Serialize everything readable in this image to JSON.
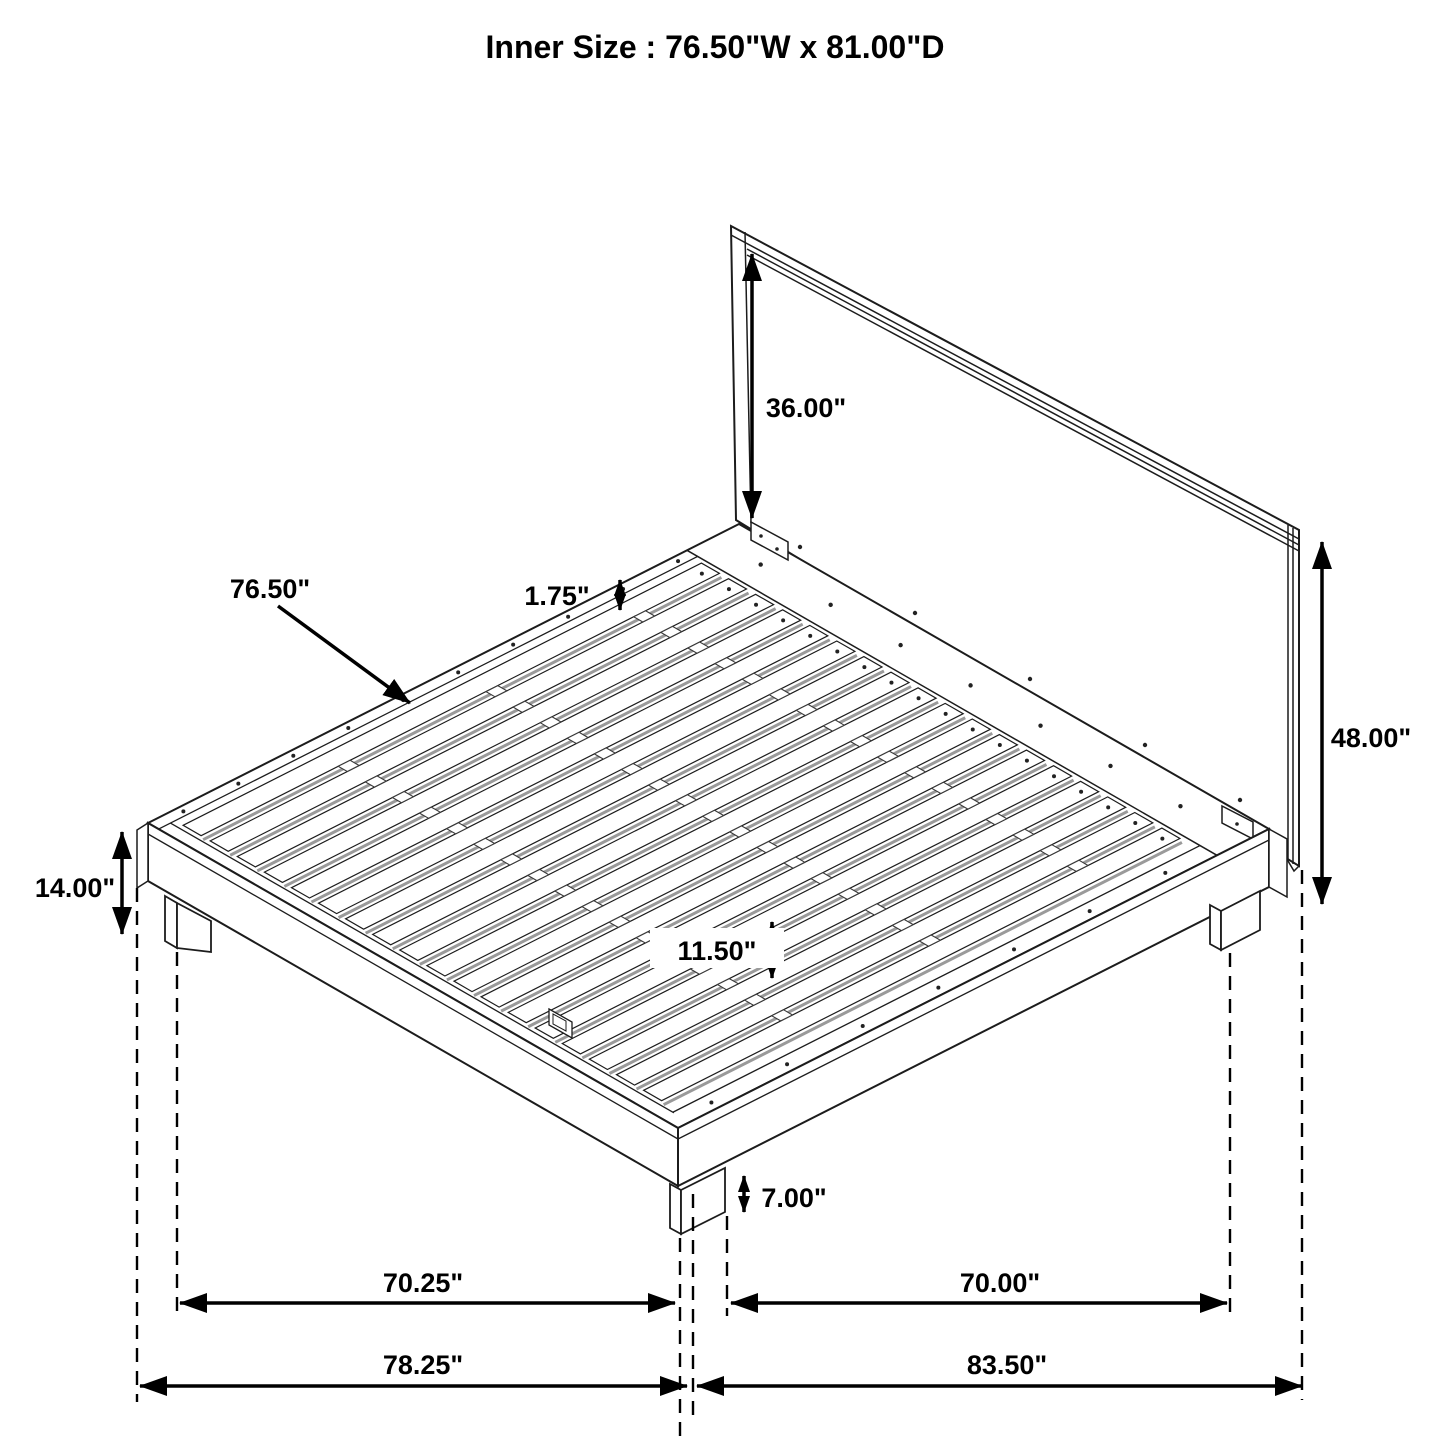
{
  "title": "Inner Size : 76.50\"W x 81.00\"D",
  "dimensions": {
    "headboard_above_platform": "36.00\"",
    "slat_length": "76.50\"",
    "slat_thickness": "1.75\"",
    "headboard_total_height": "48.00\"",
    "platform_height": "14.00\"",
    "center_support_spacing": "11.50\"",
    "leg_height": "7.00\"",
    "leg_span_front": "70.25\"",
    "leg_span_side": "70.00\"",
    "outer_width": "78.25\"",
    "outer_depth": "83.50\""
  }
}
